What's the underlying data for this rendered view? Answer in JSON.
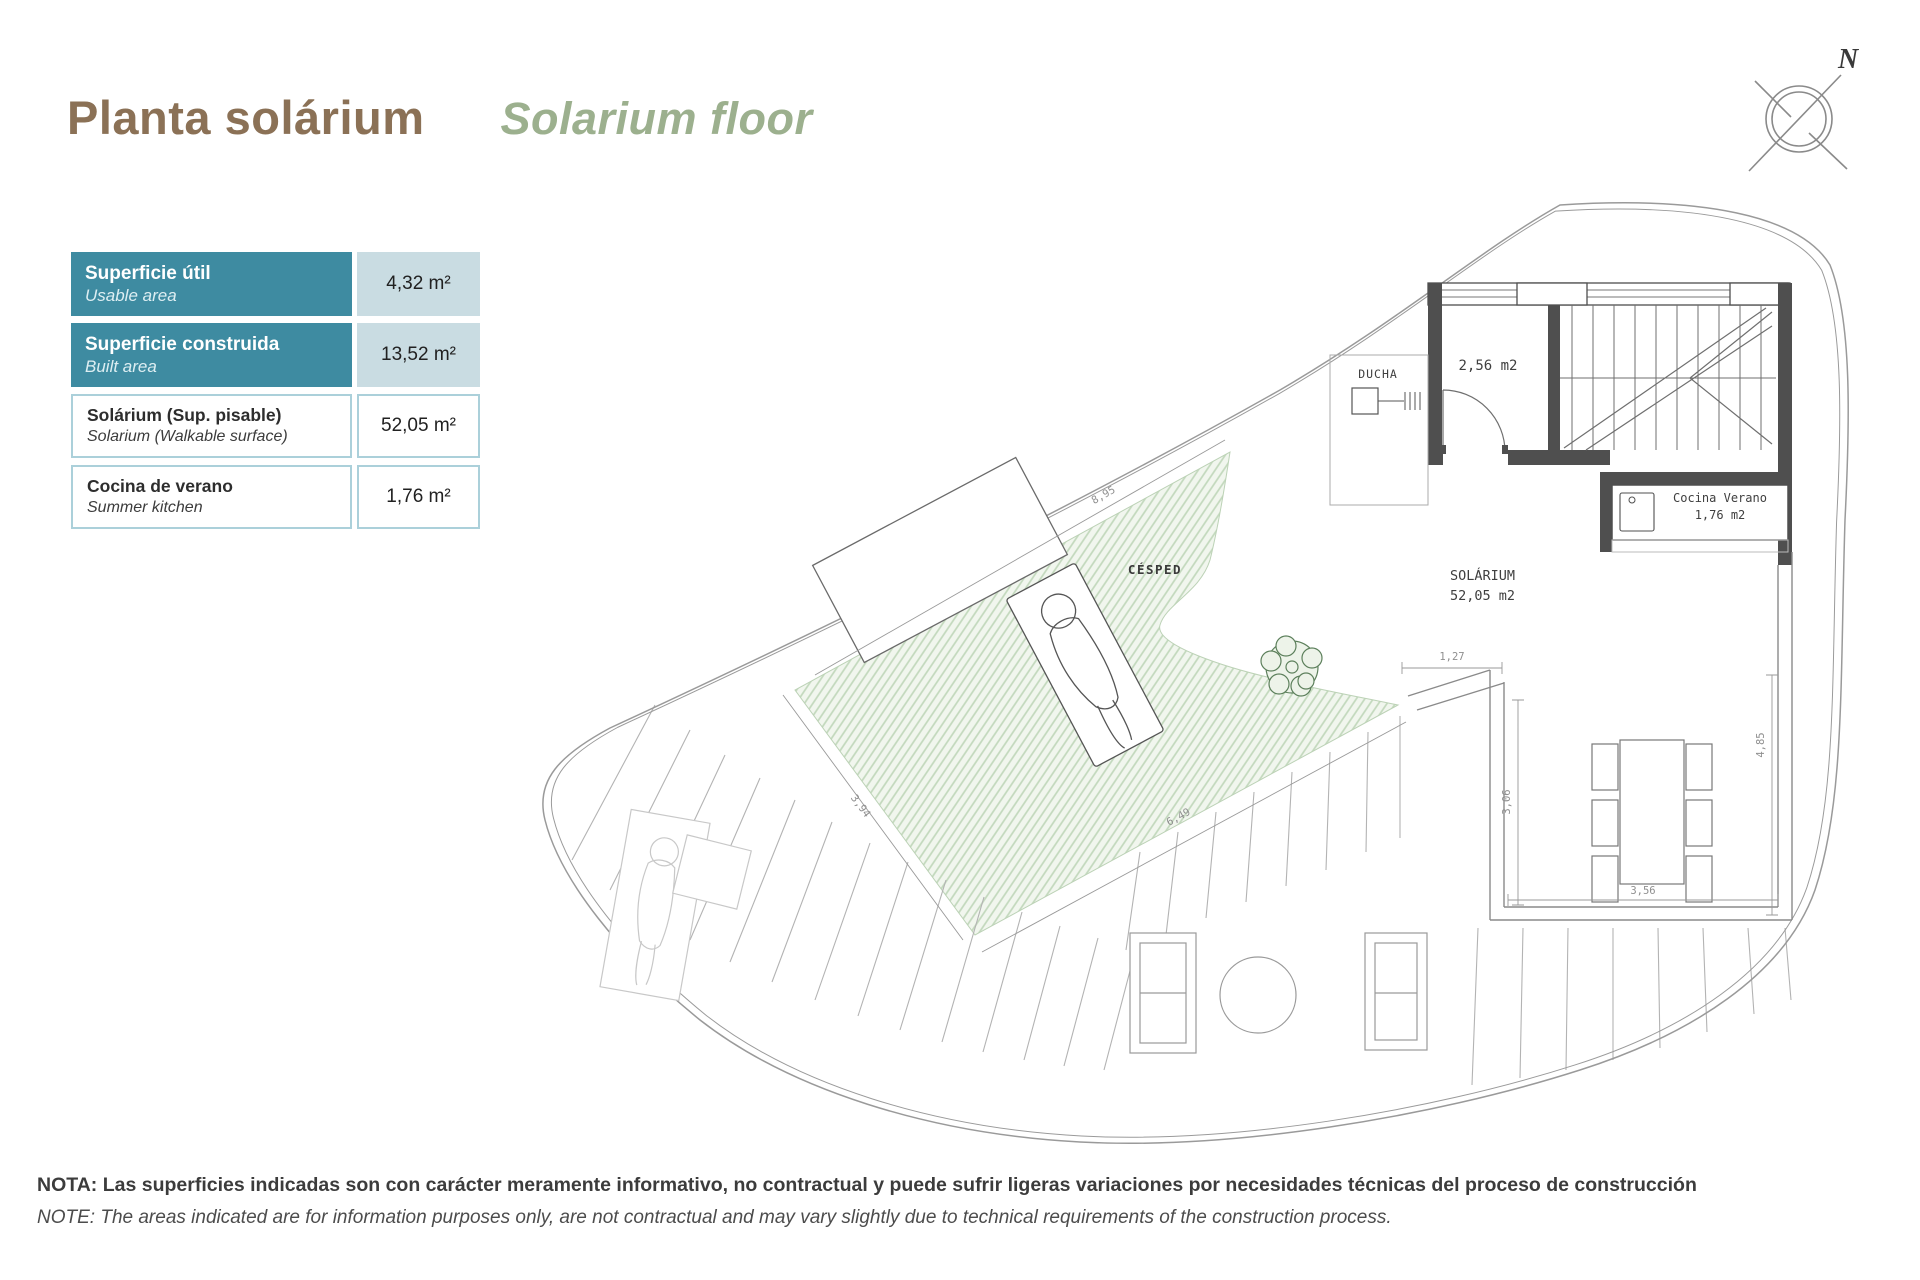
{
  "header": {
    "title_es": "Planta solárium",
    "title_en": "Solarium floor"
  },
  "compass": {
    "north_label": "N"
  },
  "area_table": {
    "rows": [
      {
        "label_es": "Superficie útil",
        "label_en": "Usable area",
        "value": "4,32 m²"
      },
      {
        "label_es": "Superficie construida",
        "label_en": "Built area",
        "value": "13,52 m²"
      },
      {
        "label_es": "Solárium (Sup. pisable)",
        "label_en": "Solarium (Walkable surface)",
        "value": "52,05 m²"
      },
      {
        "label_es": "Cocina de verano",
        "label_en": "Summer kitchen",
        "value": "1,76 m²"
      }
    ]
  },
  "floor_plan": {
    "labels": {
      "shower": "DUCHA",
      "room_area": "2,56 m2",
      "summer_kitchen_line1": "Cocina Verano",
      "summer_kitchen_line2": "1,76 m2",
      "solarium_line1": "SOLÁRIUM",
      "solarium_line2": "52,05 m2",
      "lawn": "CÉSPED"
    },
    "dimensions": {
      "lawn_top": "8,95",
      "lawn_left": "3,94",
      "lawn_bottom": "6,49",
      "terrace_top": "1,27",
      "terrace_left": "3,06",
      "terrace_right": "4,85",
      "terrace_bottom": "3,56"
    }
  },
  "footnote": {
    "line_es": "NOTA: Las superficies indicadas son con carácter meramente informativo, no contractual y puede sufrir ligeras variaciones por necesidades técnicas del proceso de construcción",
    "line_en": "NOTE: The areas indicated are for information purposes only, are not contractual and may vary slightly due to technical requirements of the construction process."
  },
  "colors": {
    "title_brown": "#8b7156",
    "title_green": "#9cb08e",
    "table_teal": "#3e8ba1",
    "table_value_bg": "#c9dce2",
    "table_border": "#abd0da",
    "wall": "#4f4f4f",
    "outline_gray": "#9a9a9a",
    "lawn_fill": "#f1f6ee",
    "lawn_hatch": "#c2d8bc",
    "tree_green": "#5d805c",
    "note_text": "#3c3c3c"
  }
}
